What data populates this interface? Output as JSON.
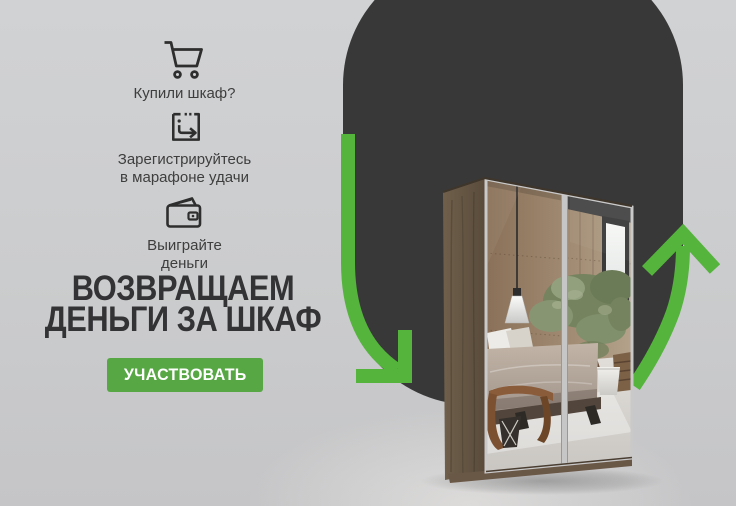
{
  "banner": {
    "steps": [
      {
        "icon": "cart-icon",
        "label": "Купили шкаф?"
      },
      {
        "icon": "register-icon",
        "label": "Зарегистрируйтесь\nв марафоне удачи"
      },
      {
        "icon": "wallet-icon",
        "label": "Выиграйте\nденьги"
      }
    ],
    "heading": {
      "line1": "ВОЗВРАЩАЕМ",
      "line2": "ДЕНЬГИ ЗА ШКАФ"
    },
    "cta": {
      "label": "УЧАСТВОВАТЬ"
    },
    "colors": {
      "background": "#cdced0",
      "blob_dark": "#383838",
      "arrow_green": "#54b43c",
      "button_green": "#57a845",
      "text_dark": "#333336"
    },
    "illustration": {
      "subject": "two-door mirrored sliding wardrobe reflecting bedroom"
    }
  }
}
